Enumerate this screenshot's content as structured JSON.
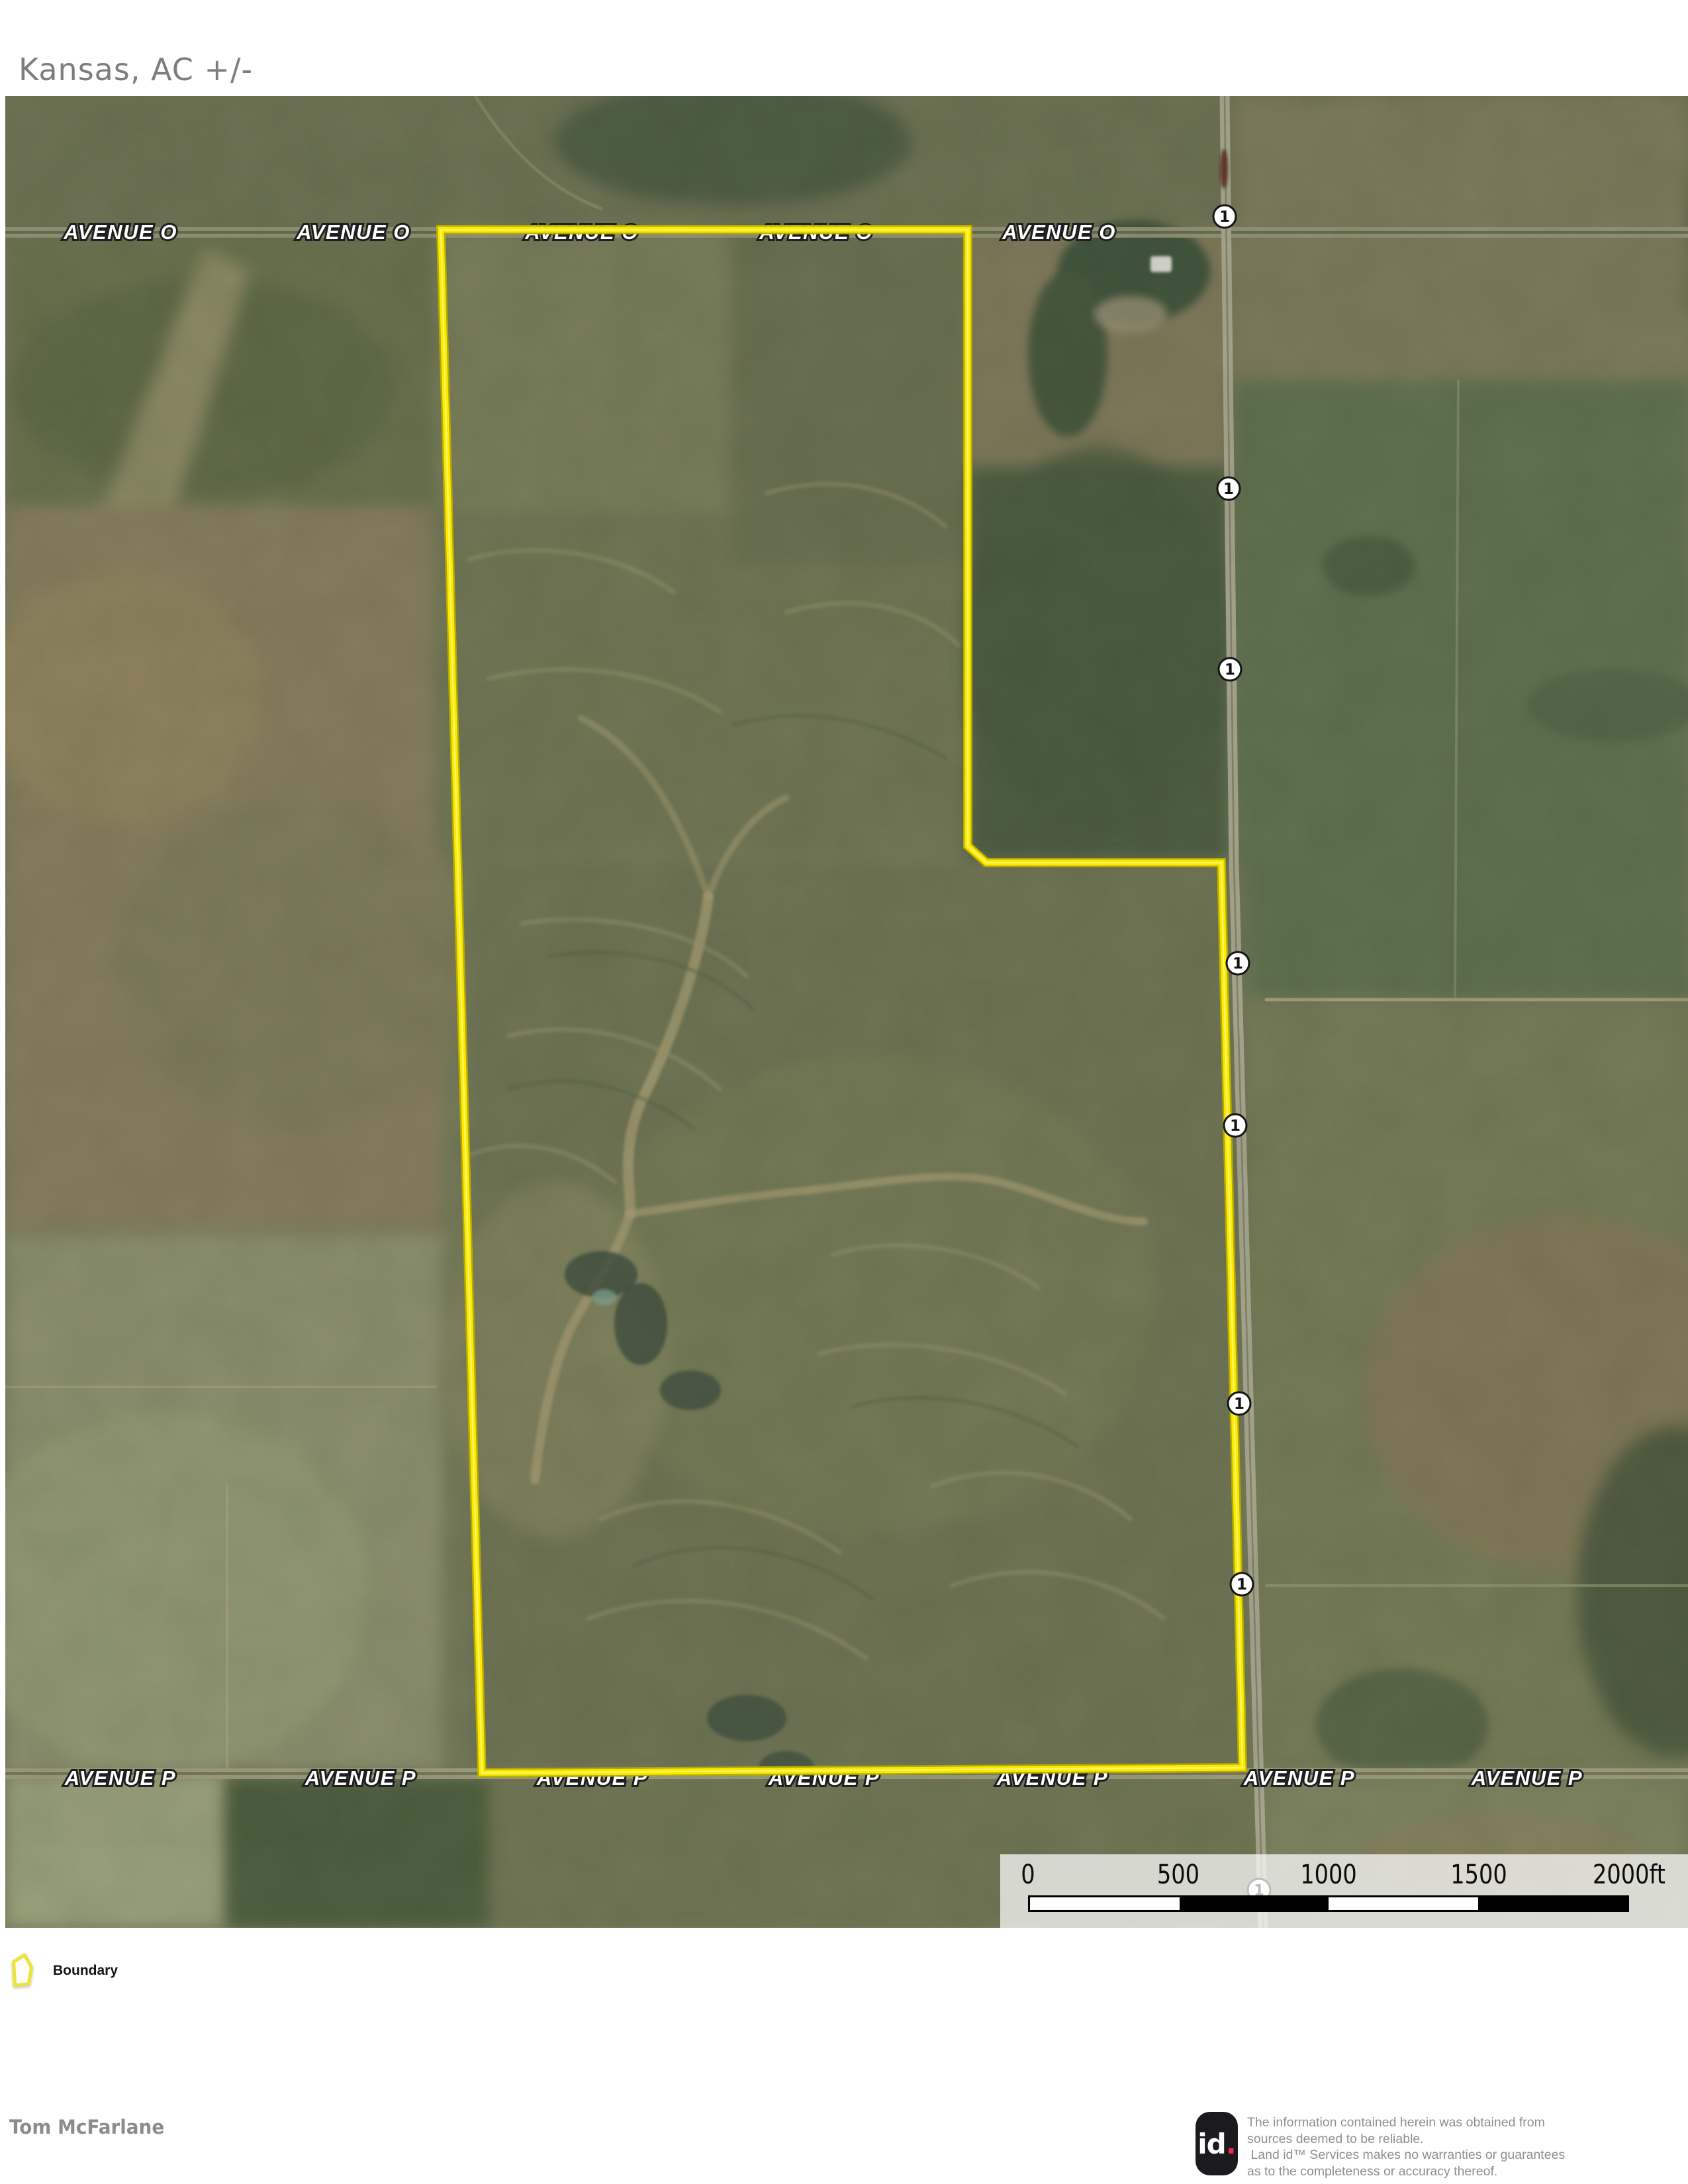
{
  "title": "Kansas,  AC +/-",
  "map": {
    "road_top": {
      "label": "AVENUE O",
      "label_y": 216,
      "label_positions_x": [
        174,
        526,
        871,
        1225,
        1592
      ]
    },
    "road_bottom": {
      "label": "AVENUE P",
      "label_y": 2551,
      "label_positions_x": [
        174,
        537,
        887,
        1237,
        1582,
        1955,
        2299
      ]
    },
    "route_marker": {
      "label": "1",
      "positions": [
        [
          1842,
          182
        ],
        [
          1848,
          593
        ],
        [
          1850,
          866
        ],
        [
          1862,
          1310
        ],
        [
          1858,
          1555
        ],
        [
          1864,
          1975
        ],
        [
          1868,
          2248
        ],
        [
          1894,
          2710
        ]
      ]
    },
    "boundary_color": "#ffe800",
    "scalebar": {
      "ticks": [
        "0",
        "500",
        "1000",
        "1500",
        "2000ft"
      ],
      "tick_offsets_x": [
        42,
        269,
        496,
        723,
        950
      ],
      "segment_colors": [
        "#ffffff",
        "#000000",
        "#ffffff",
        "#000000"
      ]
    }
  },
  "legend": {
    "items": [
      {
        "label": "Boundary"
      }
    ]
  },
  "footer": {
    "preparer": "Tom McFarlane"
  },
  "branding": {
    "logo_id": "id",
    "logo_dot": ".",
    "disclaimer_lines": [
      "The information contained herein was obtained from",
      "sources deemed to be reliable.",
      " Land id™ Services makes no warranties or guarantees",
      "as to the completeness or accuracy thereof."
    ]
  }
}
